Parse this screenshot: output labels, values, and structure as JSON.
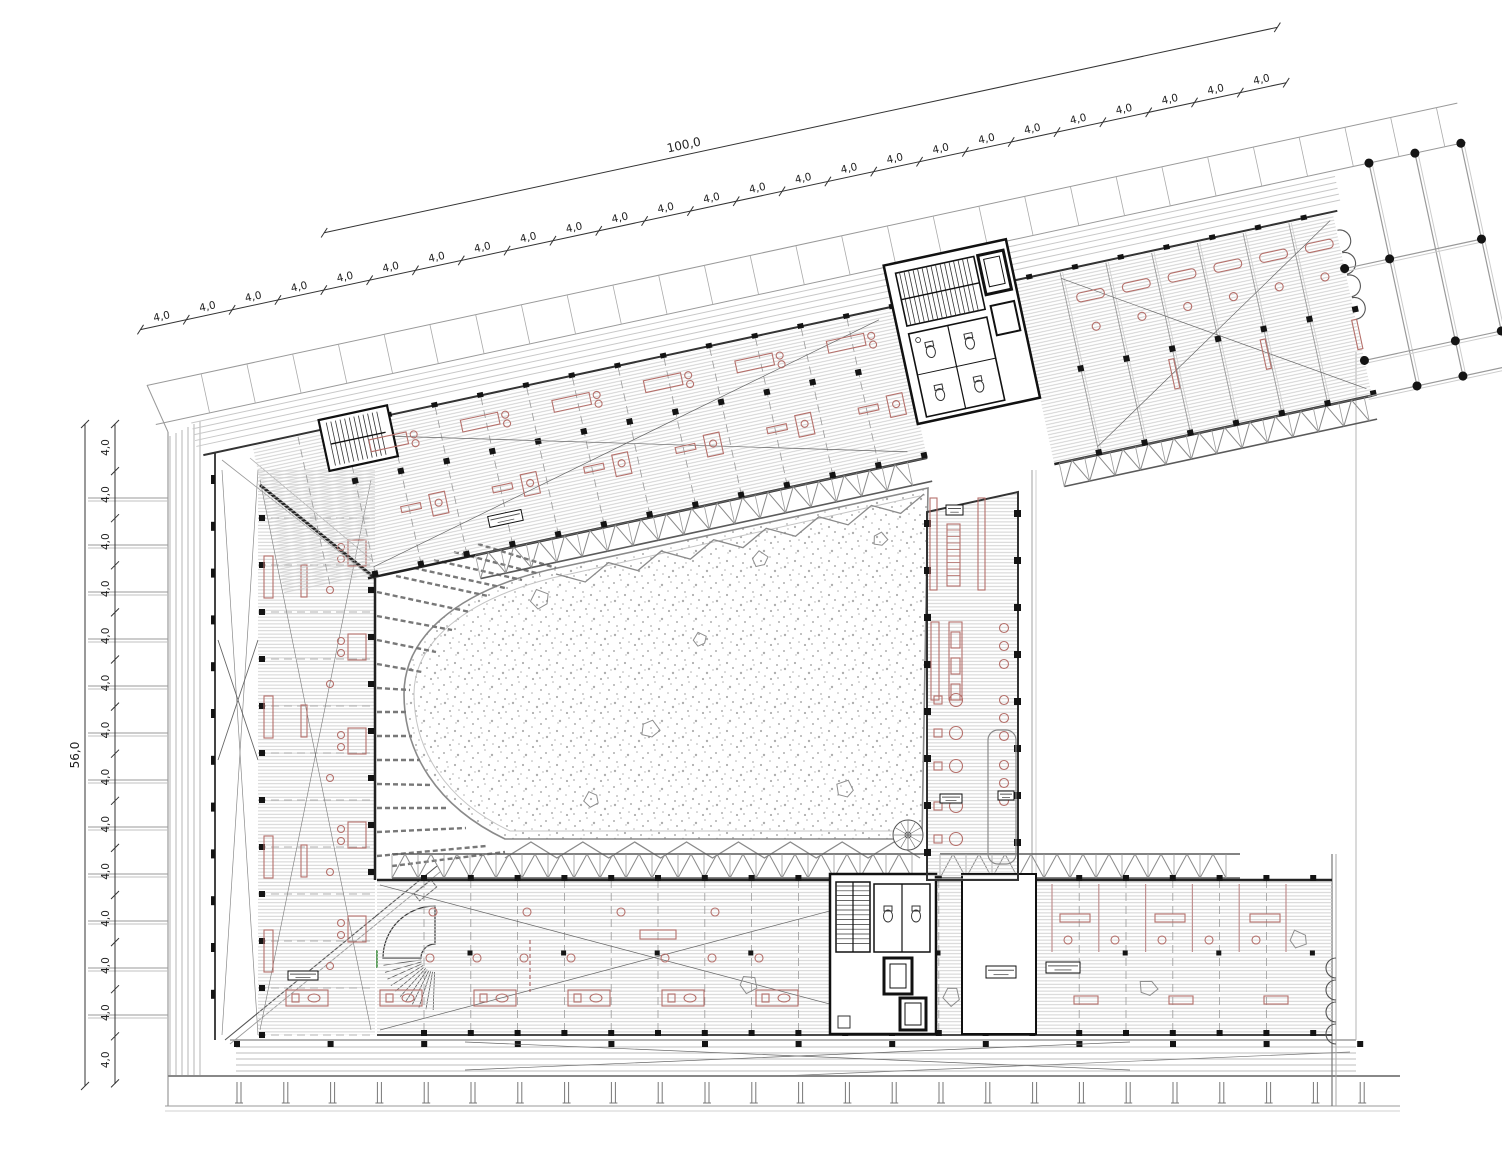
{
  "meta": {
    "type": "architectural-floor-plan",
    "description": "upper floor plan of an angled courtyard building"
  },
  "dimensions": {
    "top": {
      "overall_label": "100,0",
      "bay_label": "4,0",
      "bay_count": 25
    },
    "left": {
      "overall_label": "56,0",
      "bay_label": "4,0",
      "bay_count": 14
    }
  },
  "room_tags": [
    {
      "name": "open-office-tag",
      "legible": false
    },
    {
      "name": "central-bar-upper-tag",
      "legible": false
    },
    {
      "name": "central-bar-lower-tag-1",
      "legible": false
    },
    {
      "name": "central-bar-lower-tag-2",
      "legible": false
    },
    {
      "name": "bottom-core-tag",
      "legible": false
    },
    {
      "name": "bottom-room-tag",
      "legible": false
    },
    {
      "name": "left-wing-tag",
      "legible": false
    }
  ],
  "colors": {
    "background": "#ffffff",
    "line_dark": "#1d1d1d",
    "line_mid": "#777777",
    "line_light": "#b5b5b5",
    "hatch": "#cdcdcd",
    "furniture_red": "#b5706b",
    "partition_red": "#c09090",
    "stipple": "#aeaeae",
    "column_black": "#141414",
    "door_green": "#3c8c3c"
  }
}
